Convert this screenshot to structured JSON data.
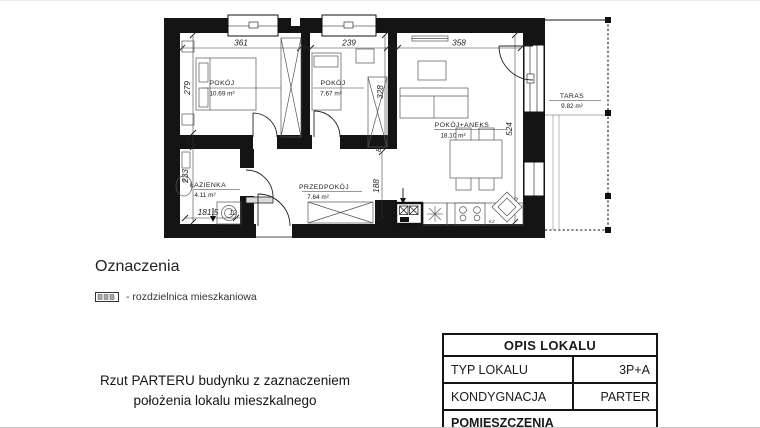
{
  "plan": {
    "rooms": [
      {
        "name": "POKÓJ",
        "area": "10.69 m²"
      },
      {
        "name": "POKÓJ",
        "area": "7.67 m²"
      },
      {
        "name": "POKÓJ+ANEKS",
        "area": "18.10 m²"
      },
      {
        "name": "ŁAZIENKA",
        "area": "4.11 m²"
      },
      {
        "name": "PRZEDPOKÓJ",
        "area": "7.64 m²"
      },
      {
        "name": "TARAS",
        "area": "9.82 m²"
      }
    ],
    "dimensions": {
      "top": [
        "361",
        "8",
        "239",
        "8",
        "358"
      ],
      "left": [
        "279",
        "12",
        "233"
      ],
      "room2_right": [
        "328",
        "8"
      ],
      "living_right": "524",
      "hall_right": "188",
      "bath_bottom": [
        "181.5",
        "12"
      ]
    },
    "kitchen_label": "KZ"
  },
  "legend": {
    "title": "Oznaczenia",
    "item": "- rozdzielnica mieszkaniowa"
  },
  "caption": {
    "line1": "Rzut PARTERU budynku z zaznaczeniem",
    "line2": "położenia lokalu mieszkalnego"
  },
  "table": {
    "header": "OPIS LOKALU",
    "rows": [
      {
        "label": "TYP LOKALU",
        "value": "3P+A"
      },
      {
        "label": "KONDYGNACJA",
        "value": "PARTER"
      }
    ],
    "footer": "POMIESZCZENIA"
  },
  "colors": {
    "wall": "#141414",
    "furniture_line": "#555555",
    "dim_text": "#1f1f1f"
  }
}
